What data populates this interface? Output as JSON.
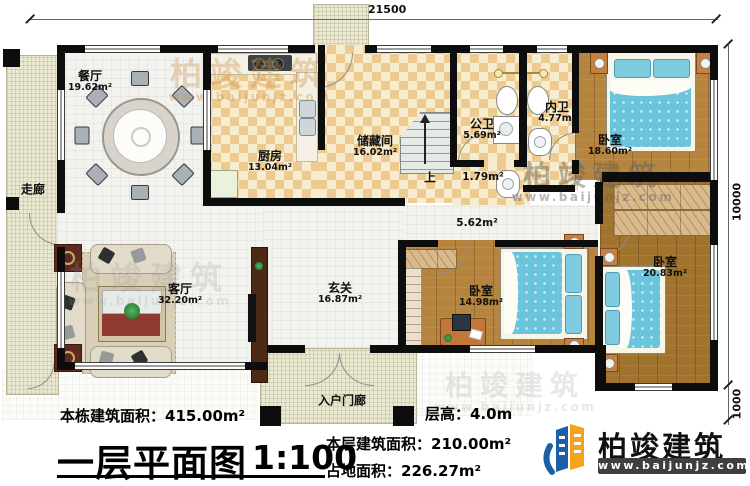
{
  "plan": {
    "footer": {
      "building_area": "本栋建筑面积：415.00m²",
      "title": "一层平面图",
      "scale": "1:100",
      "floor_area": "本层建筑面积：210.00m²",
      "land_area": "占地面积：226.27m²",
      "floor_height": "层高：4.0m"
    },
    "dimensions": {
      "width": "21500",
      "height": "10000",
      "porch_depth": "1000"
    },
    "rooms": {
      "dining": {
        "name": "餐厅",
        "area": "19.62m²"
      },
      "corridor": {
        "name": "走廊"
      },
      "kitchen": {
        "name": "厨房",
        "area": "13.04m²"
      },
      "storage": {
        "name": "储藏间",
        "area": "16.02m²"
      },
      "bath_public": {
        "name": "公卫",
        "area": "5.69m²"
      },
      "bath_inner": {
        "name": "内卫",
        "area": "4.77m²"
      },
      "bedroom_top": {
        "name": "卧室",
        "area": "18.60m²"
      },
      "bedroom_mid": {
        "name": "卧室",
        "area": "14.98m²"
      },
      "bedroom_right": {
        "name": "卧室",
        "area": "20.83m²"
      },
      "foyer": {
        "name": "玄关",
        "area": "16.87m²"
      },
      "living": {
        "name": "客厅",
        "area": "32.20m²"
      },
      "entry_porch": {
        "name": "入户门廊"
      },
      "small_hall": {
        "area": "1.79m²"
      },
      "mid_hall": {
        "area": "5.62m²"
      },
      "stairs": {
        "label": "上"
      }
    }
  },
  "brand": {
    "name": "柏竣建筑",
    "site": "www.baijunjz.com"
  },
  "watermark": {
    "text": "柏竣建筑",
    "site": "www.baijunjz.com"
  },
  "colors": {
    "wall": "#0d0d0d",
    "wood_floor": "#b5853f",
    "check_floor": "#ecca90",
    "hatch_floor": "#eae8d0",
    "bed_blue": "#69c4dc",
    "logo_blue": "#1d5fa7",
    "logo_orange": "#f6a21d"
  }
}
